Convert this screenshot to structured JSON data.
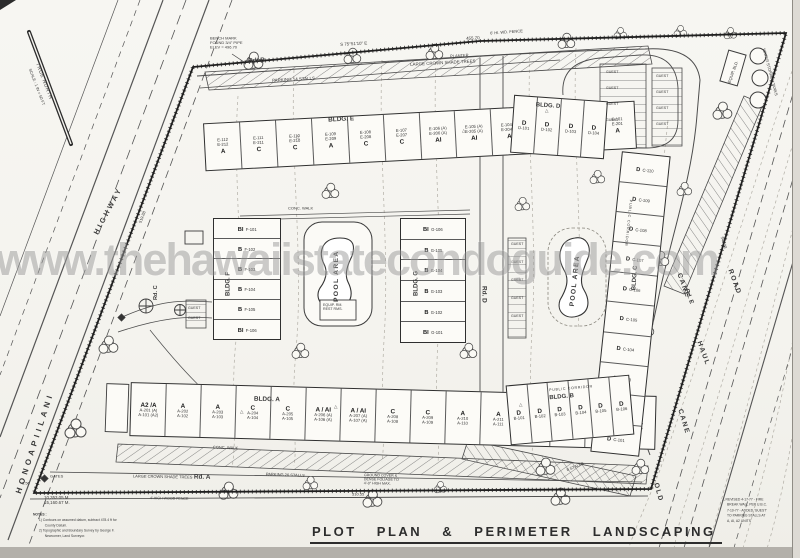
{
  "watermark": "www.thehawaiistatecondoguide.com",
  "title": {
    "text": "PLOT PLAN & PERIMETER LANDSCAPING",
    "scale": "SCALE : 1\" = 20'-0\""
  },
  "north": {
    "label": "TRUE NORTH",
    "scale": "SCALE : 1 IN = 50 FT"
  },
  "roads": {
    "honoapiilani": "HONOAPIILANI",
    "highway": "HIGHWAY",
    "rd_a": "Rd. A",
    "rd_b": "Rd. B",
    "rd_c": "Rd. C",
    "rd_d": "Rd. D",
    "rd_e": "Rd. E",
    "cane": "CANE",
    "haul": "HAUL",
    "road": "ROAD",
    "old": "OLD",
    "cane2": "CANE"
  },
  "survey": {
    "bench1": "BENCH MARK",
    "bench2": "FOUND 3/4\" PIPE",
    "bench3": "ELEV = 496.70",
    "bearing_top": "S 75°51'10\" E",
    "dim_top": "455.70",
    "dim_left": "519.88",
    "dim_right": "549.38",
    "dim_bottom": "510.55",
    "corner": "6.56",
    "area1": "10,353.05 M.",
    "area2": "15,160.67 M."
  },
  "site": {
    "pool": "POOL AREA",
    "pool_rm1": "EQUIP. RM.",
    "pool_rm2": "REST RMS.",
    "guest": "GUEST",
    "gates": "GATES",
    "planter": "PLANTER",
    "conc_walk": "CONC. WALK",
    "public_corridor": "PUBLIC CORRIDOR",
    "tanks": "WATER STORAGE TANKS",
    "equip_bld": "EQUIP. BLD.",
    "fence_top": "6' HI. WD. FENCE",
    "fence_bottom": "4' HIGH WOOD FENCE",
    "trees": "LARGE CROWN SHADE TREES",
    "parking_top": "PARKING 14 STALLS",
    "parking_bottom": "PARKING 26 STALLS",
    "stalls8": "8 STALLS",
    "ground1": "GROUND COVER &",
    "ground2": "DENSE FOLIAGE TO",
    "ground3": "4'-0\" HIGH MAX.",
    "triangle": "△"
  },
  "notes": {
    "heading": "NOTES :",
    "l1": "1) Contours on assumed datum, subtract 478.4 ft for",
    "l2": "County Datum.",
    "l3": "2) Topographic and Boundary Survey by George F.",
    "l4": "Newcomer, Land Surveyor."
  },
  "revisions": {
    "l1": "REVISED 4-17-77 - FIRE",
    "l2": "BREAK WALL PER U.B.C.",
    "l3": "7-10-77 - ADDED 'GUEST'",
    "l4": "TO PARKING STALLS AT",
    "l5": "A, AI, A2 UNITS"
  },
  "buildings": {
    "e": {
      "name": "BLDG. E",
      "units": [
        {
          "t1": "E-112",
          "t2": "E-212",
          "ty": "A"
        },
        {
          "t1": "E-111",
          "t2": "E-211",
          "ty": "C"
        },
        {
          "t1": "E-110",
          "t2": "E-210",
          "ty": "C"
        },
        {
          "t1": "E-109",
          "t2": "E-209",
          "ty": "A"
        },
        {
          "t1": "E-108",
          "t2": "E-208",
          "ty": "C"
        },
        {
          "t1": "E-107",
          "t2": "E-207",
          "ty": "C"
        },
        {
          "t1": "E-106 (A)",
          "t2": "E-206 (A)",
          "ty": "AI"
        },
        {
          "t1": "E-105 (A)",
          "t2": "E-205 (A)",
          "ty": "AI"
        },
        {
          "t1": "E-104 (A)",
          "t2": "E-204 (A)",
          "ty": "AI"
        },
        {
          "t1": "E-103",
          "t2": "E-203",
          "ty": "C"
        },
        {
          "t1": "E-102",
          "t2": "E-202",
          "ty": "C"
        },
        {
          "t1": "E-101",
          "t2": "E-201",
          "ty": "A"
        }
      ]
    },
    "a": {
      "name": "BLDG. A",
      "units": [
        {
          "ty": "A2 /A",
          "t1": "A-201 (A)",
          "t2": "A-101 (A2)"
        },
        {
          "ty": "A",
          "t1": "A-202",
          "t2": "A-102"
        },
        {
          "ty": "A",
          "t1": "A-203",
          "t2": "A-103"
        },
        {
          "ty": "C",
          "t1": "A-204",
          "t2": "A-104"
        },
        {
          "ty": "C",
          "t1": "A-205",
          "t2": "A-105"
        },
        {
          "ty": "A / AI",
          "t1": "A-206 (A)",
          "t2": "A-106 (A)"
        },
        {
          "ty": "A / AI",
          "t1": "A-207 (A)",
          "t2": "A-107 (A)"
        },
        {
          "ty": "C",
          "t1": "A-208",
          "t2": "A-108"
        },
        {
          "ty": "C",
          "t1": "A-209",
          "t2": "A-109"
        },
        {
          "ty": "A",
          "t1": "A-210",
          "t2": "A-110"
        },
        {
          "ty": "A",
          "t1": "A-211",
          "t2": "A-111"
        },
        {
          "ty": "C",
          "t1": "A-212",
          "t2": "A-112"
        },
        {
          "ty": "C",
          "t1": "A-213",
          "t2": "A-113"
        },
        {
          "ty": "C",
          "t1": "A-214",
          "t2": "A-114"
        },
        {
          "ty": "C",
          "t1": "A-215",
          "t2": "A-115"
        }
      ]
    },
    "f": {
      "name": "BLDG. F",
      "units": [
        {
          "ty": "BI",
          "n": "F-101"
        },
        {
          "ty": "B",
          "n": "F-102"
        },
        {
          "ty": "B",
          "n": "F-103"
        },
        {
          "ty": "B",
          "n": "F-104"
        },
        {
          "ty": "B",
          "n": "F-105"
        },
        {
          "ty": "BI",
          "n": "F-106"
        }
      ]
    },
    "g": {
      "name": "BLDG. G",
      "units": [
        {
          "ty": "BI",
          "n": "G-106"
        },
        {
          "ty": "B",
          "n": "G-105"
        },
        {
          "ty": "B",
          "n": "G-104"
        },
        {
          "ty": "B",
          "n": "G-103"
        },
        {
          "ty": "B",
          "n": "G-102"
        },
        {
          "ty": "BI",
          "n": "G-101"
        }
      ]
    },
    "c": {
      "name": "BLDG. C",
      "units": [
        {
          "ty": "D",
          "n": "C-110"
        },
        {
          "ty": "D",
          "n": "C-109"
        },
        {
          "ty": "D",
          "n": "C-108"
        },
        {
          "ty": "D",
          "n": "C-107"
        },
        {
          "ty": "D",
          "n": "C-106"
        },
        {
          "ty": "D",
          "n": "C-105"
        },
        {
          "ty": "D",
          "n": "C-104"
        },
        {
          "ty": "D",
          "n": "C-103"
        },
        {
          "ty": "D",
          "n": "C-102"
        },
        {
          "ty": "D",
          "n": "C-101"
        }
      ]
    },
    "d": {
      "name": "BLDG. D",
      "units": [
        {
          "ty": "D",
          "n": "D-101"
        },
        {
          "ty": "D",
          "n": "D-102"
        },
        {
          "ty": "D",
          "n": "D-103"
        },
        {
          "ty": "D",
          "n": "D-104"
        }
      ]
    },
    "b": {
      "name": "BLDG. B",
      "units": [
        {
          "ty": "D",
          "n": "B-101"
        },
        {
          "ty": "D",
          "n": "B-102"
        },
        {
          "ty": "D",
          "n": "B-103"
        },
        {
          "ty": "D",
          "n": "B-104"
        },
        {
          "ty": "D",
          "n": "B-105"
        },
        {
          "ty": "D",
          "n": "B-106"
        }
      ]
    }
  }
}
